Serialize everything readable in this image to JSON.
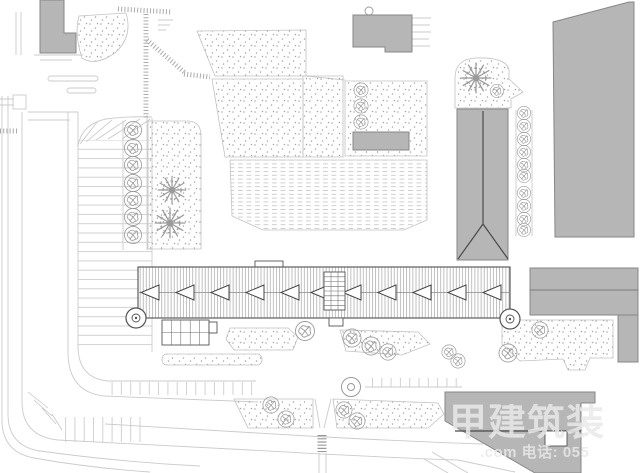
{
  "watermark": {
    "brand_text": "甲建筑装",
    "contact_text": ".com 电话: 055"
  },
  "colors": {
    "background": "#ffffff",
    "building_fill": "#b6b6b6",
    "building_stroke": "#878787",
    "dark_line": "#4a4a4a",
    "cad_line": "#cbcbcb",
    "tick_line": "#c6c6c6",
    "dot": "#a4a4a4",
    "hatch": "#9d9d9d",
    "tree": "#9b9b9b",
    "region_border": "#c2c2c2",
    "watermark": "rgba(233,233,233,0.85)"
  }
}
